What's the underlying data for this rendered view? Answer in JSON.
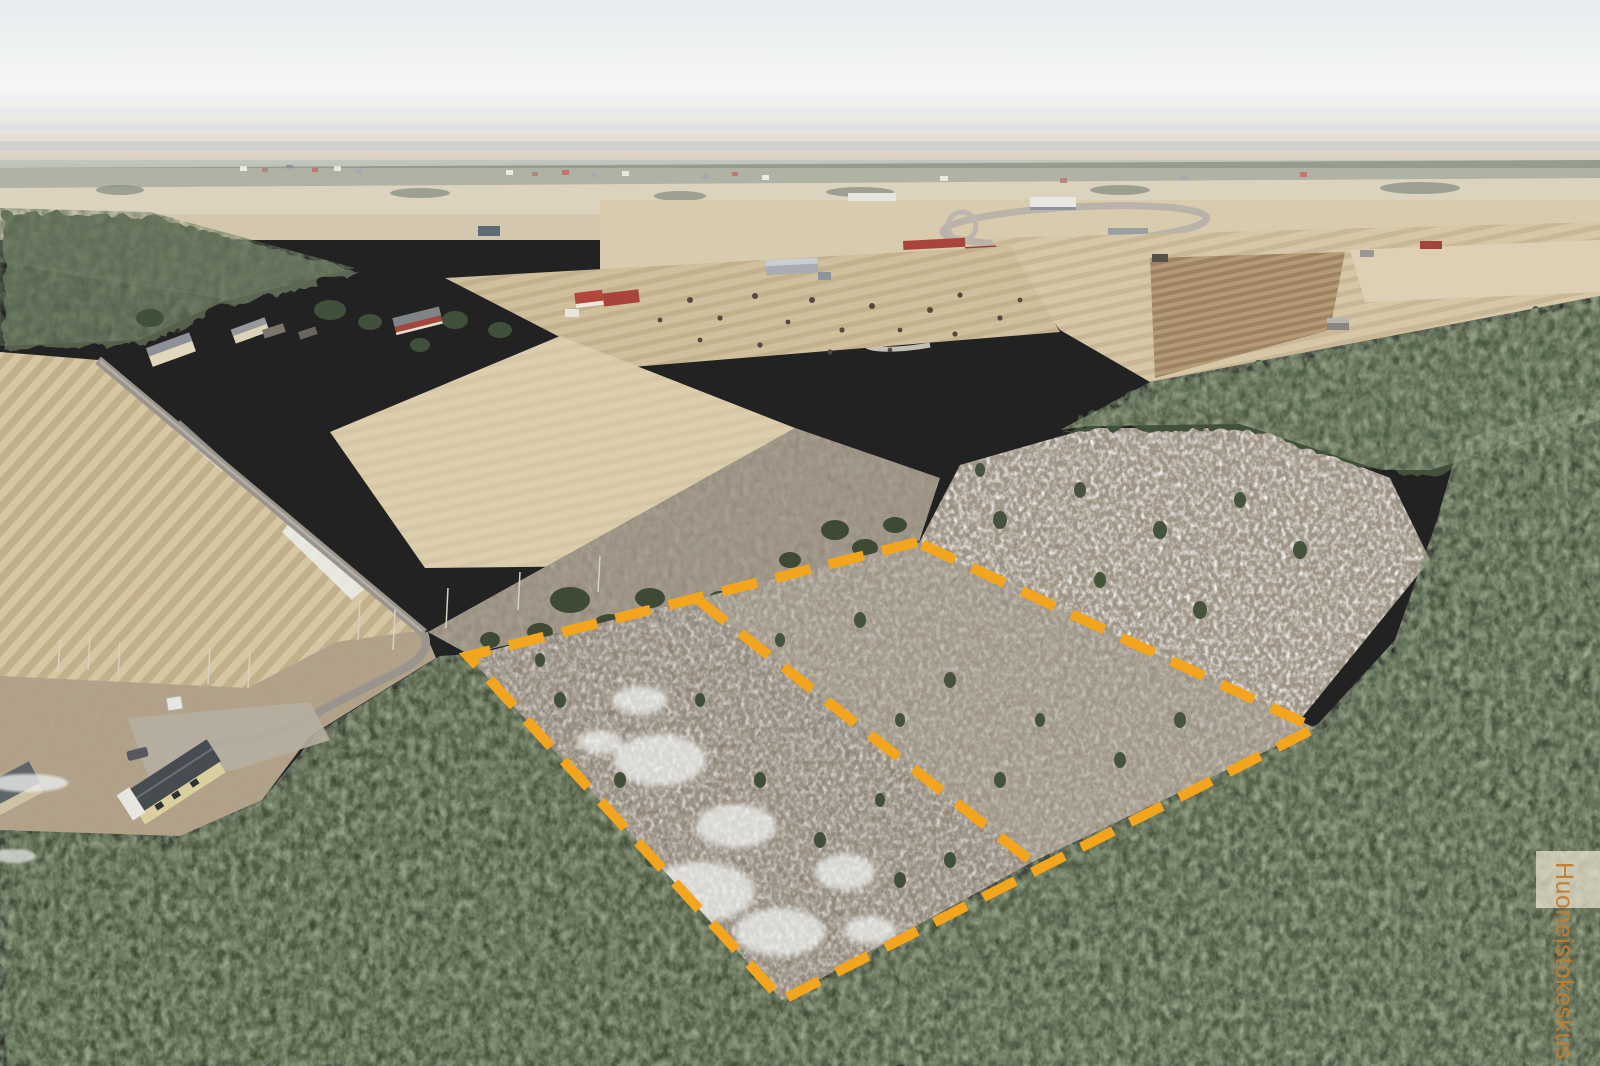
{
  "image": {
    "kind": "aerial-drone-photograph",
    "description": "Springtime aerial photo of Finnish countryside: pale tan farm fields, dark coniferous forest, a clear-cut building plot outlined with an orange dashed property boundary, houses, a gravel road and a distant trotting track under a hazy white sky.",
    "width": 1600,
    "height": 1066
  },
  "watermark": {
    "text": "Huoneistokeskus",
    "color": "#c57d2d",
    "box_color": "#ece4d1"
  },
  "boundary": {
    "color": "#F3A51D",
    "dash_css": "36 19",
    "stroke_width": "10",
    "outer_points": "917,542 468,656 782,1000 1315,728",
    "divider": {
      "x1": "697",
      "y1": "599",
      "x2": "1032",
      "y2": "862"
    }
  },
  "palette": {
    "sky_top": "#e8ecee",
    "sky_horizon": "#f7f8f6",
    "field_tan": "#d6c6a2",
    "field_brown": "#b59a76",
    "forest_dark_green": "#3f4c37",
    "clearcut_scrub": "#978c7c",
    "snow": "#e9ebe9",
    "road_grey": "#99948c",
    "roof_red": "#a8443a",
    "roof_dark": "#474c51"
  }
}
